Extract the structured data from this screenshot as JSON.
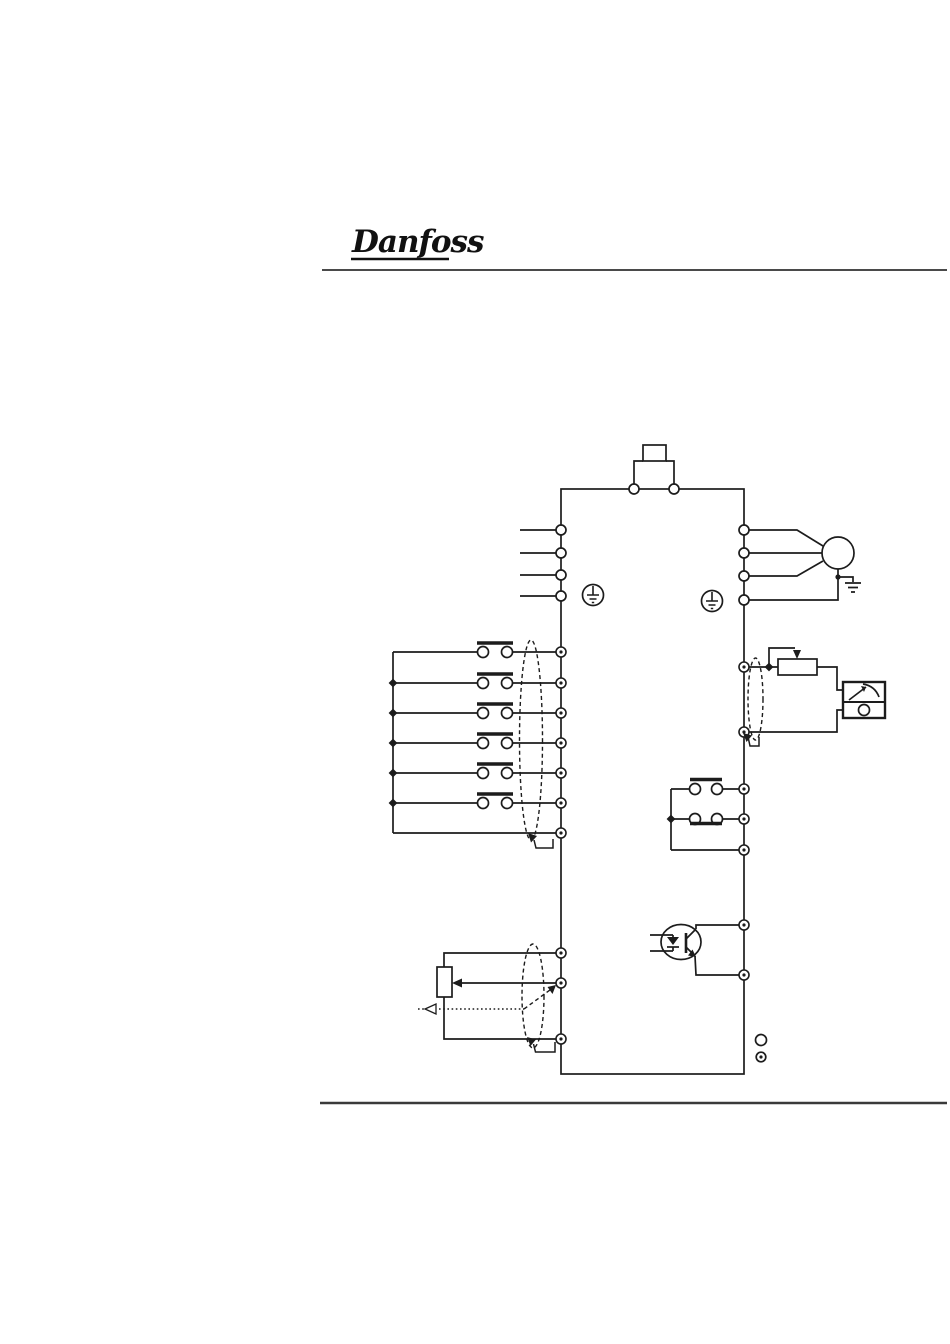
{
  "page": {
    "width": 950,
    "height": 1344,
    "background": "#ffffff"
  },
  "header": {
    "brand": "Danfoss",
    "rule_color": "#4a4a4a"
  },
  "footer": {
    "rule_color": "#3a3a3a"
  },
  "diagram": {
    "line_color": "#1c1c1c",
    "kind": "frequency-converter-connection-diagram",
    "components": [
      {
        "name": "brake-resistor",
        "terminals": 2
      },
      {
        "name": "mains-supply-terminals",
        "count": 4
      },
      {
        "name": "protective-earth-symbol",
        "count": 2
      },
      {
        "name": "motor",
        "phase-terminals": 3,
        "earth-terminal": 1
      },
      {
        "name": "analog-output-potentiometer"
      },
      {
        "name": "analog-meter"
      },
      {
        "name": "relay-output-contacts",
        "terminals": 3,
        "contacts": [
          "normally-open",
          "normally-closed"
        ]
      },
      {
        "name": "optocoupler-digital-output",
        "terminals": 2
      },
      {
        "name": "digital-input-switches",
        "count": 6
      },
      {
        "name": "reference-potentiometer"
      },
      {
        "name": "shielded-cable-oval",
        "count": 3
      }
    ],
    "legend": {
      "power_terminal_symbol": "open-circle",
      "control_terminal_symbol": "dotted-circle"
    }
  }
}
